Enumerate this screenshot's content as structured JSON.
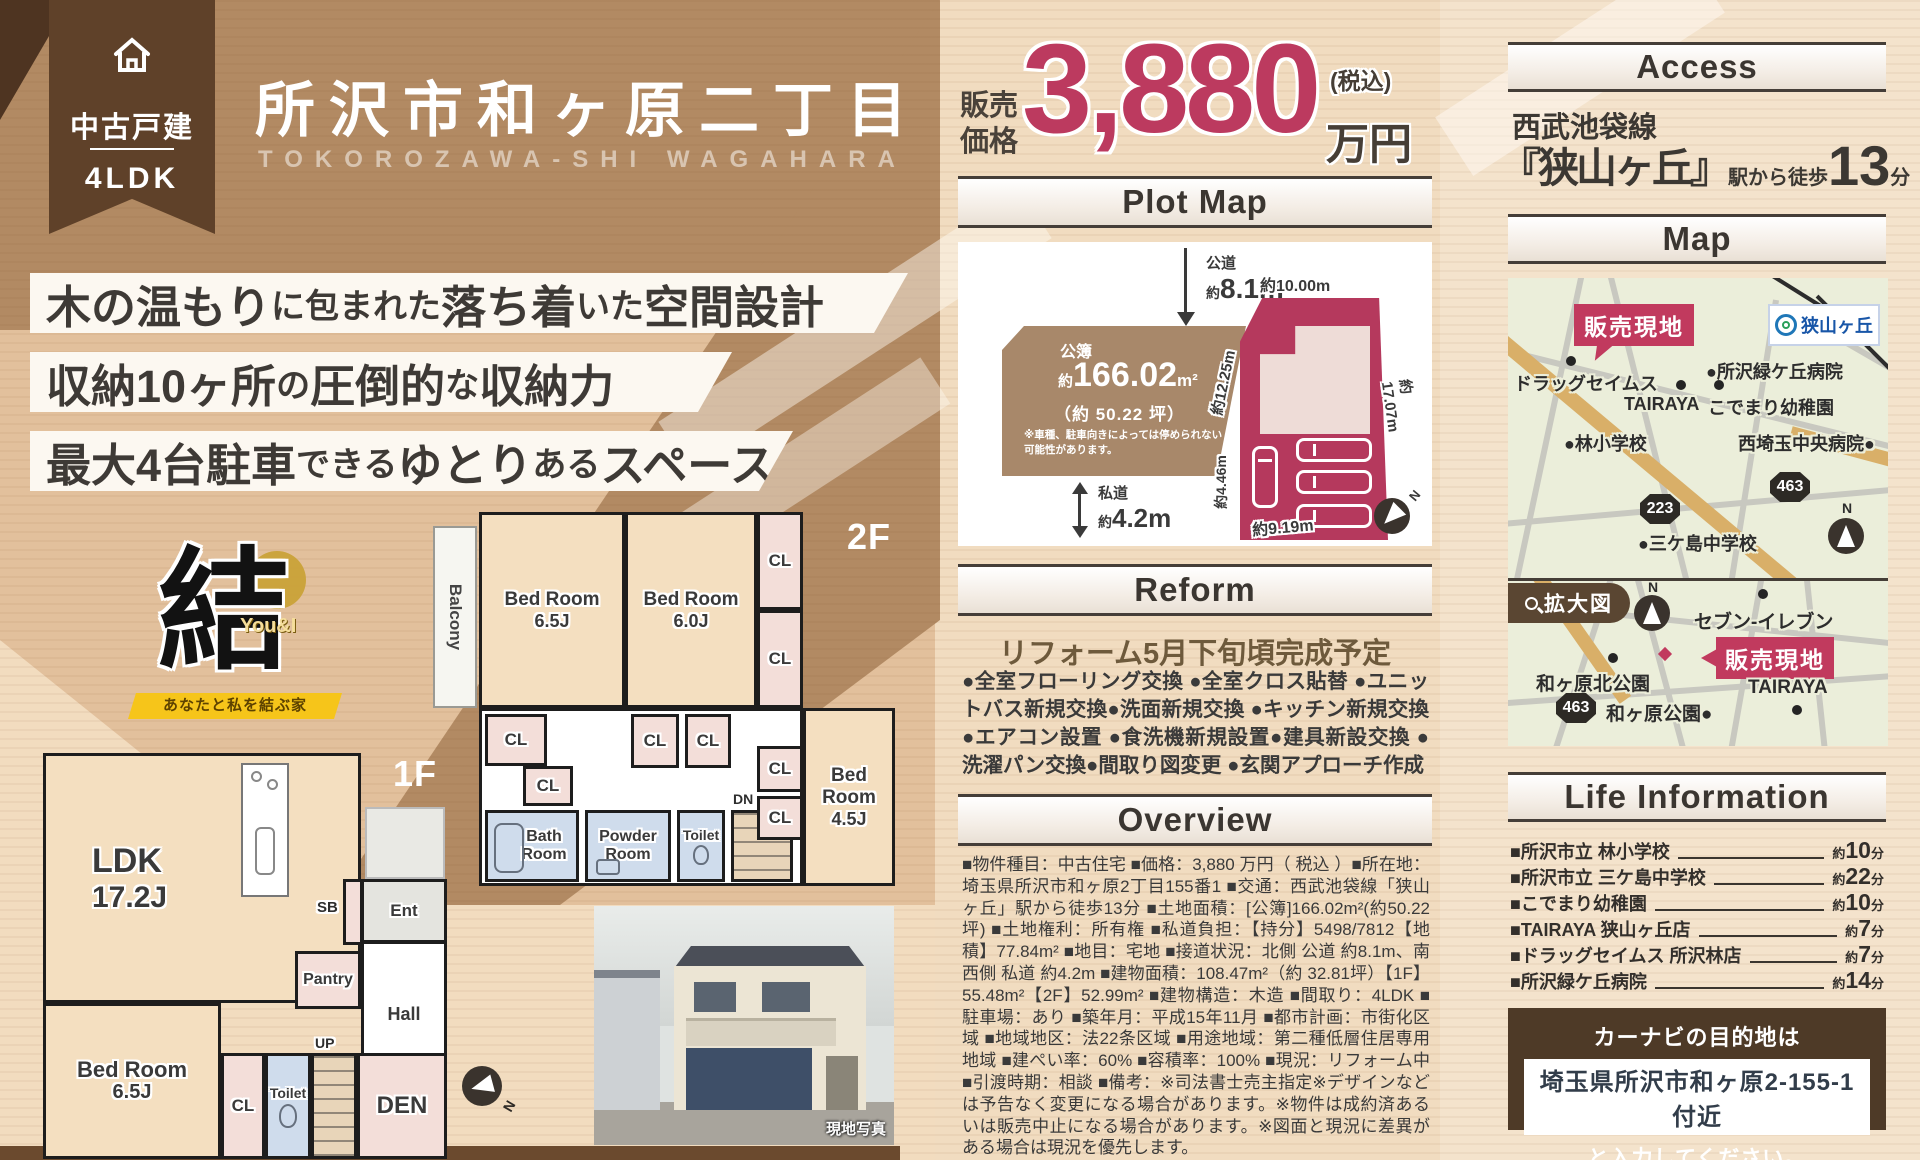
{
  "badge": {
    "type": "中古戸建",
    "plan": "4LDK"
  },
  "title": {
    "main": "所沢市和ヶ原二丁目",
    "roman": "TOKOROZAWA-SHI WAGAHARA"
  },
  "catchphrases": [
    {
      "segments": [
        {
          "t": "木の温もり",
          "s": "b"
        },
        {
          "t": "に包まれた",
          "s": "s"
        },
        {
          "t": "落ち着",
          "s": "b"
        },
        {
          "t": "いた",
          "s": "s"
        },
        {
          "t": "空間設計",
          "s": "b"
        }
      ]
    },
    {
      "segments": [
        {
          "t": "収納10ヶ所",
          "s": "b"
        },
        {
          "t": "の",
          "s": "s"
        },
        {
          "t": "圧倒的",
          "s": "b"
        },
        {
          "t": "な",
          "s": "s"
        },
        {
          "t": "収納力",
          "s": "b"
        }
      ]
    },
    {
      "segments": [
        {
          "t": "最大4台駐車",
          "s": "b"
        },
        {
          "t": "できる",
          "s": "s"
        },
        {
          "t": "ゆとり",
          "s": "b"
        },
        {
          "t": "ある",
          "s": "s"
        },
        {
          "t": "スペース",
          "s": "b"
        }
      ]
    }
  ],
  "logo": {
    "glyph": "結",
    "accent": "You&I",
    "tagline": "あなたと私を結ぶ家"
  },
  "price": {
    "label1": "販売",
    "label2": "価格",
    "amount": "3,880",
    "unit": "万円",
    "tax": "(税込)"
  },
  "plot": {
    "header": "Plot Map",
    "north_road": {
      "name": "公道",
      "approx": "約",
      "size": "8.1m"
    },
    "south_road": {
      "name": "私道",
      "approx": "約",
      "size": "4.2m"
    },
    "parcel": {
      "register": "公簿",
      "approx": "約",
      "area": "166.02",
      "area_unit": "m²",
      "tsubo": "（約 50.22 坪）",
      "note": "※車種、駐車向きによっては停められない可能性があります。"
    },
    "dims": {
      "top": "約10.00m",
      "left": "約12.25m",
      "right": "約17.07m",
      "bottom_left": "約4.46m",
      "bottom": "約9.19m"
    },
    "north": "N"
  },
  "reform": {
    "header": "Reform",
    "subtitle": "リフォーム5月下旬頃完成予定",
    "body": "●全室フローリング交換 ●全室クロス貼替 ●ユニットバス新規交換●洗面新規交換 ●キッチン新規交換 ●エアコン設置 ●食洗機新規設置●建具新設交換 ●洗濯パン交換●間取り図変更 ●玄関アプローチ作成"
  },
  "overview": {
    "header": "Overview",
    "body": "■物件種目：中古住宅 ■価格：3,880 万円（ 税込 ）■所在地：埼玉県所沢市和ヶ原2丁目155番1 ■交通：西武池袋線「狭山ヶ丘」駅から徒歩13分 ■土地面積：[公簿]166.02m²(約50.22坪) ■土地権利：所有権 ■私道負担：【持分】5498/7812【地積】77.84m² ■地目：宅地 ■接道状況：北側 公道 約8.1m、南西側 私道 約4.2m ■建物面積：108.47m²（約 32.81坪）【1F】55.48m²【2F】52.99m² ■建物構造：木造 ■間取り：4LDK ■駐車場：あり ■築年月：平成15年11月 ■都市計画：市街化区域 ■地域地区：法22条区域 ■用途地域：第二種低層住居専用地域 ■建ぺい率：60% ■容積率：100% ■現況：リフォーム中 ■引渡時期：相談 ■備考：※司法書士売主指定※デザインなどは予告なく変更になる場合があります。※物件は成約済あるいは販売中止になる場合があります。※図面と現況に差異がある場合は現況を優先します。"
  },
  "access": {
    "header": "Access",
    "line": "西武池袋線",
    "station": "『狭山ヶ丘』",
    "suffix": "駅から徒歩",
    "minutes": "13",
    "unit": "分"
  },
  "map": {
    "header": "Map",
    "zoom_tab": "拡大図",
    "upper": {
      "sale": "販売現地",
      "station": "狭山ヶ丘",
      "drug": "ドラッグセイムス",
      "hospital1": "●所沢緑ケ丘病院",
      "tairaya": "TAIRAYA",
      "kindergarten": "こでまり幼稚園",
      "elementary": "●林小学校",
      "hospital2": "西埼玉中央病院●",
      "junior": "●三ケ島中学校",
      "route223": "223",
      "route463": "463",
      "north": "N"
    },
    "lower": {
      "seven": "セブン-イレブン",
      "sale": "販売現地",
      "park_north": "和ヶ原北公園",
      "route463": "463",
      "park": "和ヶ原公園●",
      "tairaya": "TAIRAYA",
      "north": "N"
    }
  },
  "life": {
    "header": "Life Information",
    "approx": "約",
    "unit": "分",
    "items": [
      {
        "name": "■所沢市立 林小学校",
        "time": "10"
      },
      {
        "name": "■所沢市立 三ケ島中学校",
        "time": "22"
      },
      {
        "name": "■こでまり幼稚園",
        "time": "10"
      },
      {
        "name": "■TAIRAYA 狭山ヶ丘店",
        "time": "7"
      },
      {
        "name": "■ドラッグセイムス 所沢林店",
        "time": "7"
      },
      {
        "name": "■所沢緑ケ丘病院",
        "time": "14"
      }
    ]
  },
  "carnav": {
    "line1": "カーナビの目的地は",
    "address": "埼玉県所沢市和ヶ原2-155-1 付近",
    "line3": "と入力してください。"
  },
  "floorplan": {
    "f2_label": "2F",
    "f1_label": "1F",
    "photo_caption": "現地写真",
    "north": "N",
    "rooms": {
      "balcony": "Balcony",
      "bed_name": "Bed Room",
      "bed65": "6.5J",
      "bed60": "6.0J",
      "bed45": "4.5J",
      "cl": "CL",
      "dn": "DN",
      "up": "UP",
      "bath1": "Bath",
      "bath2": "Room",
      "powder1": "Powder",
      "powder2": "Room",
      "toilet": "Toilet",
      "ldk_name": "LDK",
      "ldk_size": "17.2J",
      "ent": "Ent",
      "sb": "SB",
      "pantry": "Pantry",
      "hall": "Hall",
      "den": "DEN"
    }
  }
}
